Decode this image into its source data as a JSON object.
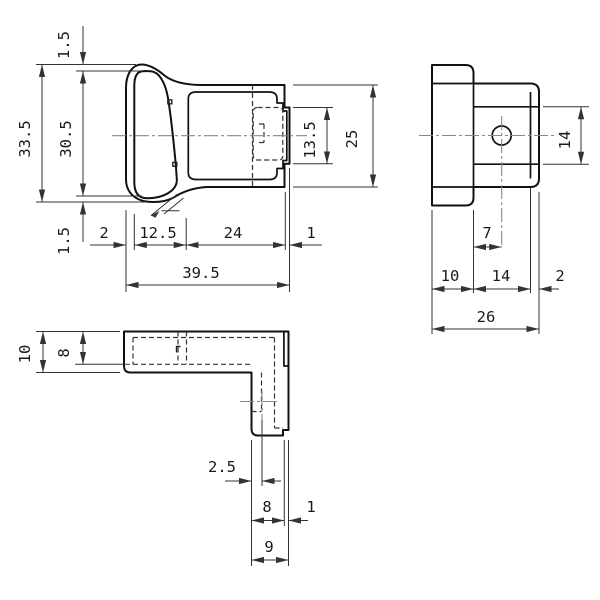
{
  "drawing": {
    "views": {
      "front": {
        "dims": {
          "wall_top": "1.5",
          "height_outer": "33.5",
          "height_inner": "30.5",
          "wall_bottom": "1.5",
          "seg_left": "2",
          "seg_oval": "12.5",
          "seg_body": "24",
          "seg_lip": "1",
          "width_total": "39.5",
          "tab_height": "13.5",
          "body_height": "25"
        }
      },
      "side": {
        "dims": {
          "band_height": "14",
          "hole_offset": "7",
          "seg_left": "10",
          "seg_mid": "14",
          "seg_right": "2",
          "width_total": "26"
        }
      },
      "bottom": {
        "dims": {
          "depth_outer": "10",
          "depth_inner": "8",
          "center_offset": "2.5",
          "bar_main": "8",
          "bar_lip": "1",
          "bar_total": "9"
        }
      }
    },
    "colors": {
      "line": "#111111",
      "dim": "#333333",
      "centerline": "#888888",
      "background": "#ffffff"
    }
  }
}
